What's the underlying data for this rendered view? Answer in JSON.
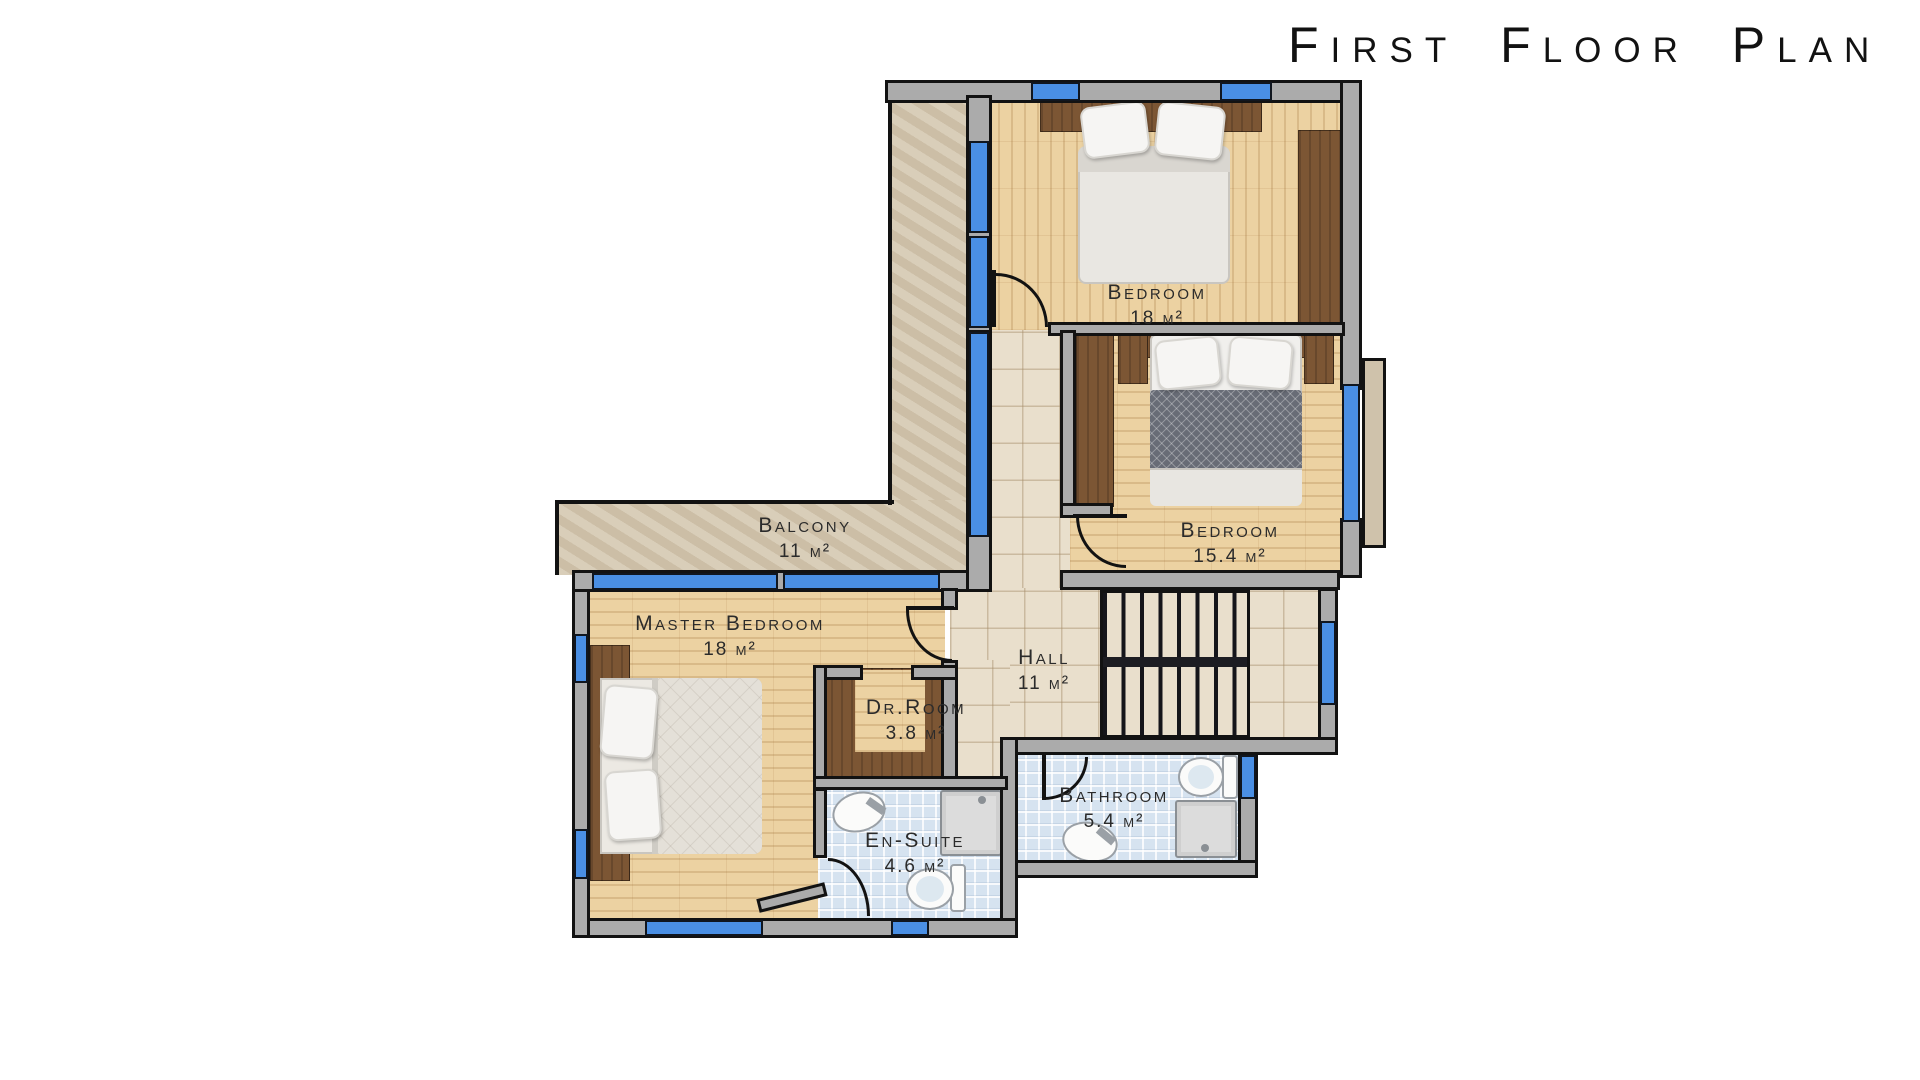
{
  "title": "First Floor Plan",
  "rooms": {
    "bedroom1": {
      "name": "Bedroom",
      "area": "18 m²"
    },
    "bedroom2": {
      "name": "Bedroom",
      "area": "15.4 m²"
    },
    "master": {
      "name": "Master Bedroom",
      "area": "18 m²"
    },
    "balcony": {
      "name": "Balcony",
      "area": "11 m²"
    },
    "hall": {
      "name": "Hall",
      "area": "11 m²"
    },
    "dressing": {
      "name": "Dr.Room",
      "area": "3.8 m²"
    },
    "ensuite": {
      "name": "En-Suite",
      "area": "4.6 m²"
    },
    "bathroom": {
      "name": "Bathroom",
      "area": "5.4 m²"
    }
  },
  "palette": {
    "window_glass": "#4a8fe4",
    "wall_fill": "#ababab",
    "wall_outline": "#121212",
    "wood_floor": "#ecd2a2",
    "dark_wood": "#7c5634",
    "hall_tile": "#e9dfcc",
    "bath_tile": "#d6e3f0",
    "balcony_stone": "#d5c8b1"
  },
  "fixtures": [
    "double-bed",
    "wardrobe",
    "staircase",
    "toilet",
    "sink",
    "shower-tray",
    "door-swing",
    "window"
  ]
}
